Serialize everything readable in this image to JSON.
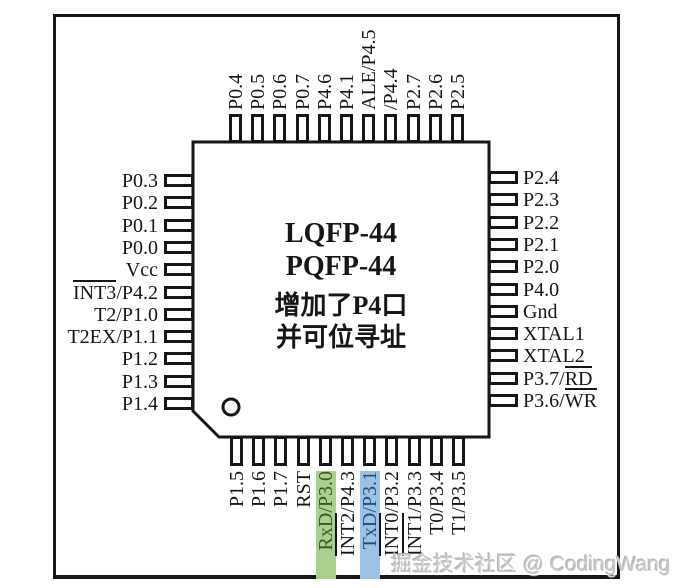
{
  "diagram": {
    "package_labels": [
      "LQFP-44",
      "PQFP-44"
    ],
    "note_lines": [
      "增加了P4口",
      "并可位寻址"
    ]
  },
  "watermark": {
    "text": "掘金技术社区 @ CodingWang"
  },
  "colors": {
    "line": "#161616",
    "highlight_green": "#a9d08e",
    "highlight_blue": "#9cc2e5",
    "green_text": "#375623",
    "blue_text": "#1f4e79"
  },
  "pins": {
    "top": [
      {
        "num": "33",
        "segments": [
          {
            "t": "P0.4"
          }
        ]
      },
      {
        "num": "32",
        "segments": [
          {
            "t": "P0.5"
          }
        ]
      },
      {
        "num": "31",
        "segments": [
          {
            "t": "P0.6"
          }
        ]
      },
      {
        "num": "30",
        "segments": [
          {
            "t": "P0.7"
          }
        ]
      },
      {
        "num": "29",
        "segments": [
          {
            "t": "P4.6"
          }
        ]
      },
      {
        "num": "28",
        "segments": [
          {
            "t": "P4.1"
          }
        ]
      },
      {
        "num": "27",
        "segments": [
          {
            "t": "ALE/P4.5"
          }
        ]
      },
      {
        "num": "26",
        "segments": [
          {
            "t": "/P4.4"
          }
        ]
      },
      {
        "num": "25",
        "segments": [
          {
            "t": "P2.7"
          }
        ]
      },
      {
        "num": "24",
        "segments": [
          {
            "t": "P2.6"
          }
        ]
      },
      {
        "num": "23",
        "segments": [
          {
            "t": "P2.5"
          }
        ]
      }
    ],
    "left": [
      {
        "num": "34",
        "segments": [
          {
            "t": "P0.3"
          }
        ]
      },
      {
        "num": "35",
        "segments": [
          {
            "t": "P0.2"
          }
        ]
      },
      {
        "num": "36",
        "segments": [
          {
            "t": "P0.1"
          }
        ]
      },
      {
        "num": "37",
        "segments": [
          {
            "t": "P0.0"
          }
        ]
      },
      {
        "num": "38",
        "segments": [
          {
            "t": "Vcc"
          }
        ]
      },
      {
        "num": "39",
        "segments": [
          {
            "t": "INT3",
            "overline": true
          },
          {
            "t": "/P4.2"
          }
        ]
      },
      {
        "num": "40",
        "segments": [
          {
            "t": "T2/P1.0"
          }
        ]
      },
      {
        "num": "41",
        "segments": [
          {
            "t": "T2EX/P1.1"
          }
        ]
      },
      {
        "num": "42",
        "segments": [
          {
            "t": "P1.2"
          }
        ]
      },
      {
        "num": "43",
        "segments": [
          {
            "t": "P1.3"
          }
        ]
      },
      {
        "num": "44",
        "segments": [
          {
            "t": "P1.4"
          }
        ]
      }
    ],
    "right": [
      {
        "num": "22",
        "segments": [
          {
            "t": "P2.4"
          }
        ]
      },
      {
        "num": "21",
        "segments": [
          {
            "t": "P2.3"
          }
        ]
      },
      {
        "num": "20",
        "segments": [
          {
            "t": "P2.2"
          }
        ]
      },
      {
        "num": "19",
        "segments": [
          {
            "t": "P2.1"
          }
        ]
      },
      {
        "num": "18",
        "segments": [
          {
            "t": "P2.0"
          }
        ]
      },
      {
        "num": "17",
        "segments": [
          {
            "t": "P4.0"
          }
        ]
      },
      {
        "num": "16",
        "segments": [
          {
            "t": "Gnd"
          }
        ]
      },
      {
        "num": "15",
        "segments": [
          {
            "t": "XTAL1"
          }
        ]
      },
      {
        "num": "14",
        "segments": [
          {
            "t": "XTAL2"
          }
        ]
      },
      {
        "num": "13",
        "segments": [
          {
            "t": "P3.7/"
          },
          {
            "t": "RD",
            "overline": true
          }
        ]
      },
      {
        "num": "12",
        "segments": [
          {
            "t": "P3.6/"
          },
          {
            "t": "WR",
            "overline": true
          }
        ]
      }
    ],
    "bottom": [
      {
        "num": "1",
        "segments": [
          {
            "t": "P1.5"
          }
        ]
      },
      {
        "num": "2",
        "segments": [
          {
            "t": "P1.6"
          }
        ]
      },
      {
        "num": "3",
        "segments": [
          {
            "t": "P1.7"
          }
        ]
      },
      {
        "num": "4",
        "segments": [
          {
            "t": "RST"
          }
        ]
      },
      {
        "num": "5",
        "segments": [
          {
            "t": "RxD/P3.0"
          }
        ],
        "highlight": "green"
      },
      {
        "num": "6",
        "segments": [
          {
            "t": "INT2",
            "overline": true
          },
          {
            "t": "/P4.3"
          }
        ]
      },
      {
        "num": "7",
        "segments": [
          {
            "t": "TxD/P3.1"
          }
        ],
        "highlight": "blue"
      },
      {
        "num": "8",
        "segments": [
          {
            "t": "INT0",
            "overline": true
          },
          {
            "t": "/P3.2"
          }
        ]
      },
      {
        "num": "9",
        "segments": [
          {
            "t": "INT1",
            "overline": true
          },
          {
            "t": "/P3.3"
          }
        ]
      },
      {
        "num": "10",
        "segments": [
          {
            "t": "T0/P3.4"
          }
        ]
      },
      {
        "num": "11",
        "segments": [
          {
            "t": "T1/P3.5"
          }
        ]
      }
    ]
  }
}
